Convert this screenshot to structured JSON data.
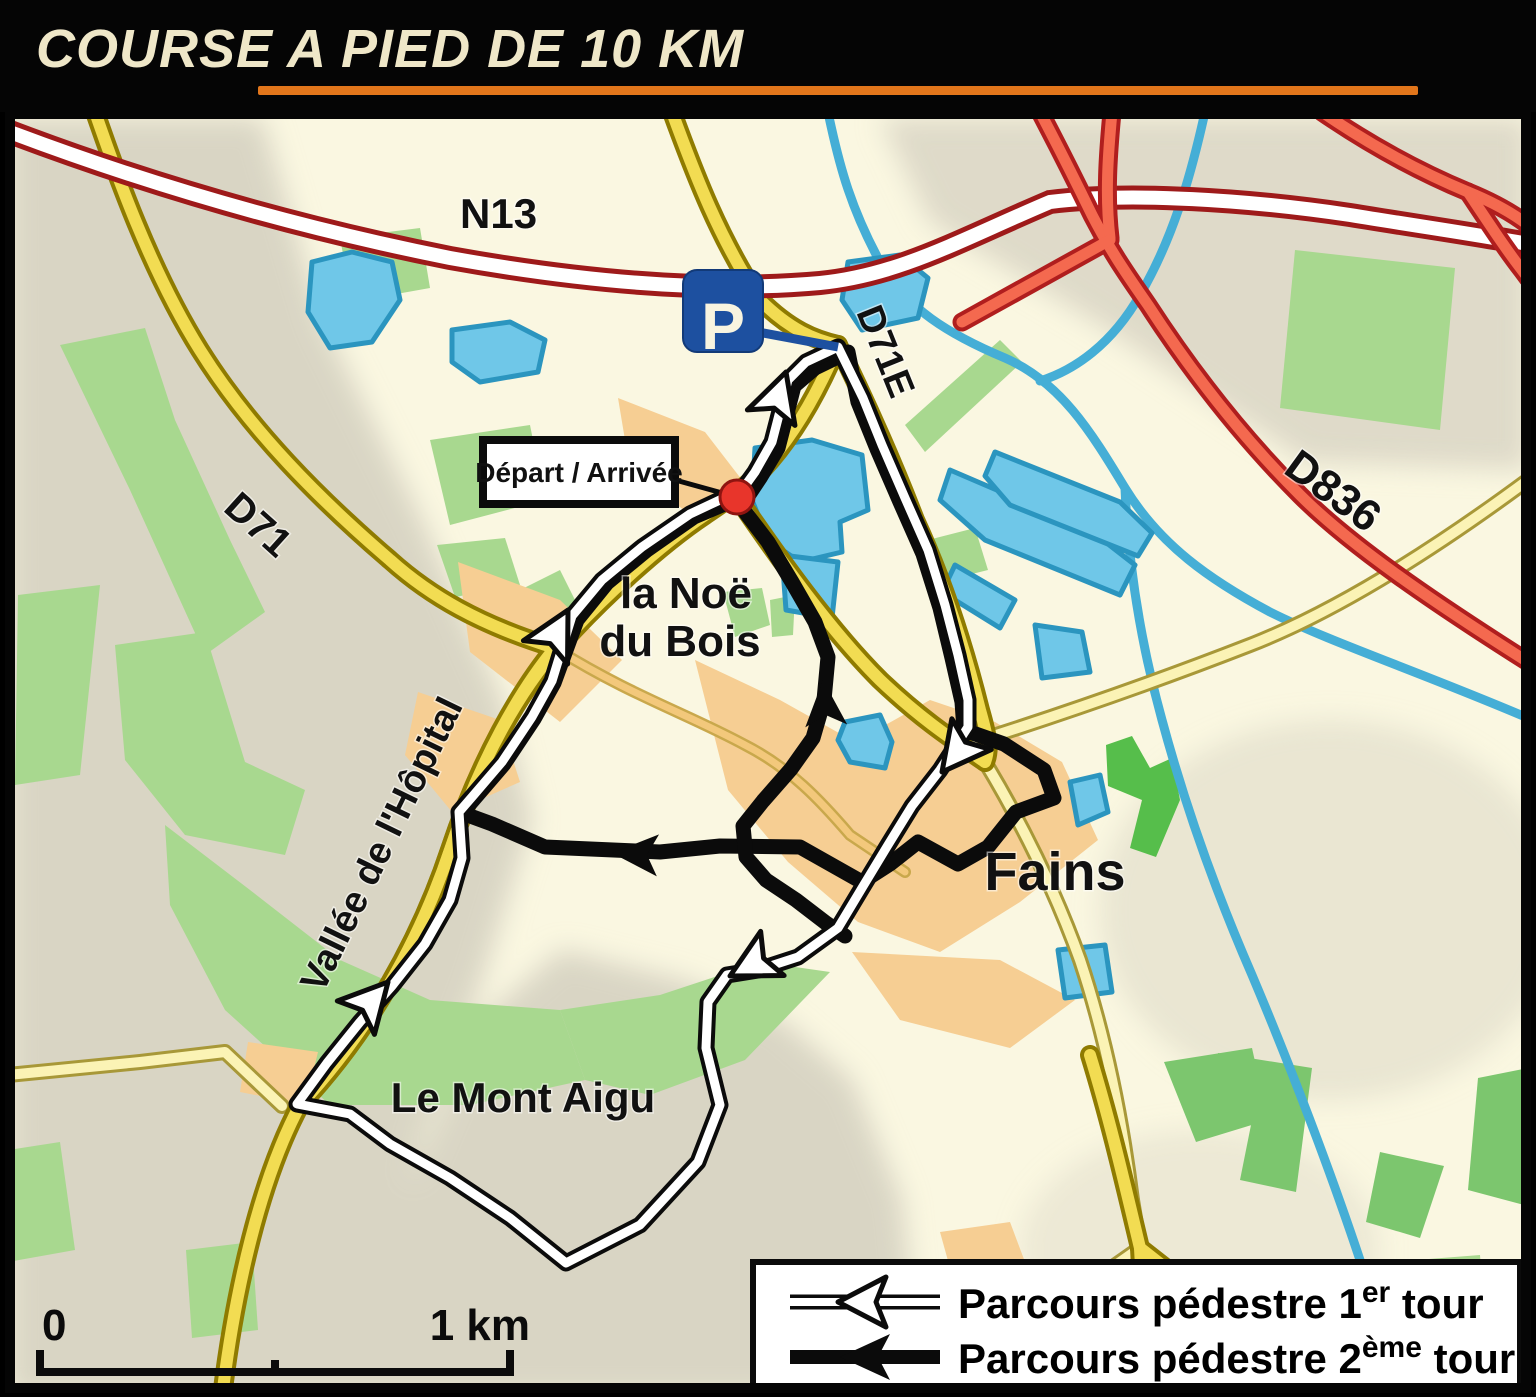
{
  "title": {
    "text": "COURSE A PIED DE 10 KM"
  },
  "map": {
    "road_labels": {
      "n13": "N13",
      "d71": "D71",
      "d71e": "D71E",
      "d836": "D836"
    },
    "place_labels": {
      "la_noe_line1": "la Noë",
      "la_noe_line2": "du Bois",
      "fains": "Fains",
      "le_mont_aigu": "Le Mont Aigu",
      "vallee": "Vallée de l'Hôpital"
    },
    "markers": {
      "depart_arrivee": "Départ / Arrivée",
      "parking": "P"
    }
  },
  "scale_bar": {
    "zero": "0",
    "one_km": "1 km"
  },
  "legend": {
    "row1": {
      "prefix": "Parcours pédestre 1",
      "sup": "er",
      "suffix": " tour"
    },
    "row2": {
      "prefix": "Parcours pédestre 2",
      "sup": "ème",
      "suffix": " tour"
    }
  },
  "colors": {
    "accent_orange": "#E2761B",
    "title_cream": "#EFE7C8",
    "map_cream": "#FAF7E1",
    "terrain_gray": "#D9D5C4",
    "forest_green": "#A8D88F",
    "bright_green": "#56BE4B",
    "water_blue": "#6FC7E8",
    "river_blue": "#45AED6",
    "road_yellow": "#F2DC52",
    "road_pale": "#FBF3B5",
    "built_up_orange": "#F6CE93",
    "motorway_red": "#F4694F",
    "n13_casing": "#9E1A1A",
    "route_black": "#0B0B0B",
    "route_white": "#FFFFFF",
    "parking_blue": "#1D50A0",
    "marker_red": "#E8352B"
  }
}
